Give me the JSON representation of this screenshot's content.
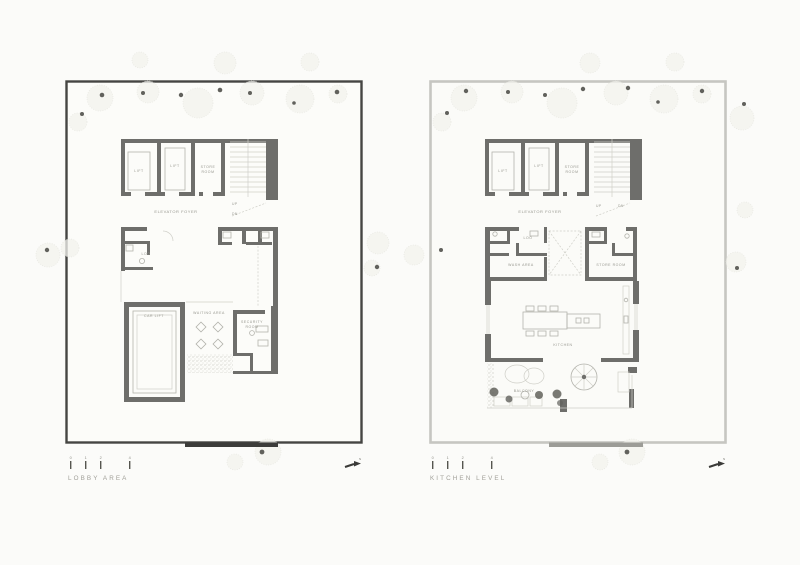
{
  "colors": {
    "paper": "#fbfbf9",
    "wall": "#6e6e6b",
    "boundary_dark": "#454543",
    "boundary_light": "#c6c6c1",
    "label": "#97978f",
    "line_light": "#cfcfc8",
    "fixture": "#b3b3ac",
    "tree_dot": "#61615c",
    "entrance_left": "#3c3c3a",
    "entrance_right": "#9c9c97"
  },
  "plans": [
    {
      "title": "LOBBY AREA",
      "scale_ticks": [
        "0",
        "1",
        "2",
        "4"
      ],
      "north": "N",
      "rooms": {
        "lift_a": "LIFT",
        "lift_b": "LIFT",
        "store_l1": "STORE",
        "store_l2": "ROOM",
        "foyer": "ELEVATOR FOYER",
        "up": "UP",
        "dn": "DN",
        "loo": "LOO",
        "car_lift": "CAR LIFT",
        "waiting": "WAITING AREA",
        "security_l1": "SECURITY",
        "security_l2": "ROOM"
      }
    },
    {
      "title": "KITCHEN LEVEL",
      "scale_ticks": [
        "0",
        "1",
        "2",
        "4"
      ],
      "north": "N",
      "rooms": {
        "lift_a": "LIFT",
        "lift_b": "LIFT",
        "store_l1": "STORE",
        "store_l2": "ROOM",
        "foyer": "ELEVATOR FOYER",
        "up": "UP",
        "dn": "DN",
        "loo": "LOO",
        "wash": "WASH AREA",
        "store2": "STORE ROOM",
        "kitchen": "KITCHEN",
        "balcony": "BALCONY"
      }
    }
  ]
}
